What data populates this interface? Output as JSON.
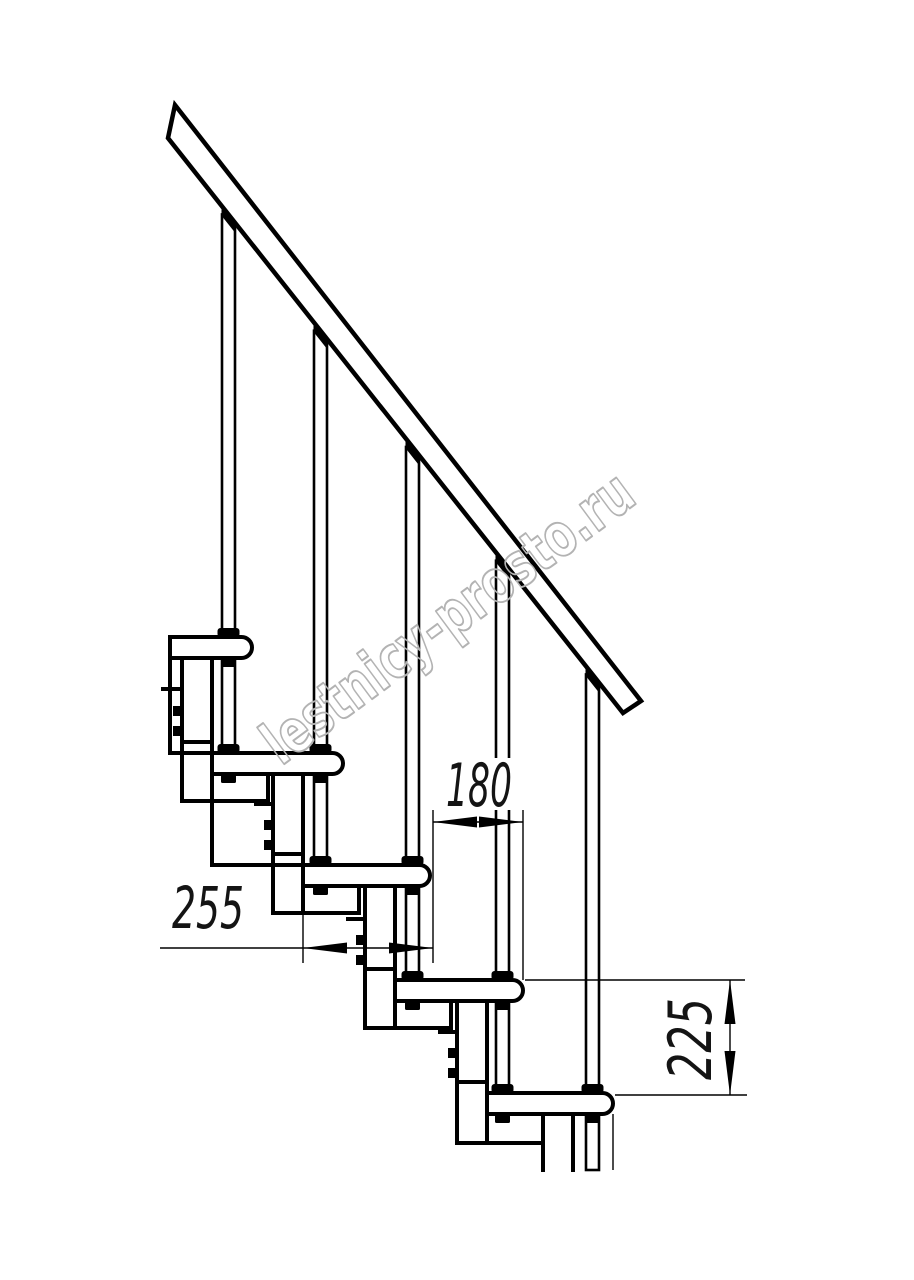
{
  "page": {
    "background": "#ffffff"
  },
  "drawing": {
    "type": "technical-drawing",
    "subject": "modular-staircase-side-elevation",
    "watermark": {
      "text": "lestnicy-prosto.ru",
      "color": "#b3b3b3",
      "angle_deg": -36.5,
      "cx": 460,
      "cy": 634,
      "font_size": 60,
      "text_length": 445
    },
    "dimensions": [
      {
        "label": "180",
        "meaning": "tread run spacing (mm)",
        "orientation": "horizontal"
      },
      {
        "label": "255",
        "meaning": "tread depth (mm)",
        "orientation": "horizontal"
      },
      {
        "label": "225",
        "meaning": "step rise (mm)",
        "orientation": "vertical"
      }
    ],
    "colors": {
      "line": "#000000",
      "dimension_text": "#141414",
      "watermark": "#b3b3b3"
    },
    "geometry": {
      "rail": {
        "points": "175,105 641,701 623,713 168,138"
      },
      "rail_ref": {
        "x0": 168,
        "y0": 138,
        "slope": 1.2637
      },
      "rods": {
        "centers": [
          228.5,
          320.5,
          412.5,
          502.5,
          592.5
        ],
        "width": 13,
        "bottom": 1170
      },
      "steps": {
        "h": 21,
        "r": 10.5,
        "items": [
          {
            "x": 170,
            "y": 637,
            "w": 82
          },
          {
            "x": 212,
            "y": 753,
            "w": 131
          },
          {
            "x": 303,
            "y": 865,
            "w": 127
          },
          {
            "x": 395,
            "y": 980,
            "w": 128
          },
          {
            "x": 487,
            "y": 1093,
            "w": 126
          }
        ]
      },
      "thick_v": [
        [
          170,
          637,
          753
        ],
        [
          182,
          658,
          801
        ],
        [
          212,
          658,
          865
        ],
        [
          268,
          774,
          801
        ],
        [
          273,
          774,
          913
        ],
        [
          303,
          774,
          913
        ],
        [
          359,
          886,
          913
        ],
        [
          365,
          886,
          1028
        ],
        [
          395,
          886,
          1028
        ],
        [
          451,
          1001,
          1028
        ],
        [
          457,
          1001,
          1143
        ],
        [
          487,
          1001,
          1143
        ],
        [
          543,
          1114,
          1170
        ],
        [
          573,
          1114,
          1170
        ]
      ],
      "thick_h": [
        [
          163,
          182,
          689
        ],
        [
          182,
          212,
          742
        ],
        [
          170,
          212,
          753
        ],
        [
          182,
          268,
          801
        ],
        [
          256,
          273,
          804
        ],
        [
          273,
          303,
          854
        ],
        [
          212,
          303,
          865
        ],
        [
          273,
          359,
          913
        ],
        [
          348,
          365,
          919
        ],
        [
          365,
          395,
          969
        ],
        [
          365,
          451,
          1028
        ],
        [
          440,
          457,
          1032
        ],
        [
          457,
          487,
          1082
        ],
        [
          457,
          543,
          1143
        ]
      ],
      "clips": [
        [
          173,
          706
        ],
        [
          173,
          726
        ],
        [
          264,
          820
        ],
        [
          264,
          840
        ],
        [
          356,
          935
        ],
        [
          356,
          955
        ],
        [
          448,
          1048
        ],
        [
          448,
          1068
        ]
      ],
      "clip_size": [
        9,
        10
      ],
      "thin_v": [
        [
          613,
          1114,
          1170
        ],
        [
          303,
          888,
          963
        ],
        [
          433,
          810,
          963
        ],
        [
          523,
          810,
          980
        ],
        [
          730,
          980,
          1095
        ]
      ],
      "thin_h": [
        [
          160,
          433,
          948
        ],
        [
          433,
          523,
          822
        ],
        [
          525,
          745,
          980
        ],
        [
          615,
          747,
          1095
        ]
      ],
      "arrows": [
        [
          303,
          948,
          347,
          942.5,
          347,
          953.5
        ],
        [
          433,
          948,
          389,
          942.5,
          389,
          953.5
        ],
        [
          433,
          822,
          477,
          816.5,
          477,
          827.5
        ],
        [
          523,
          822,
          479,
          816.5,
          479,
          827.5
        ],
        [
          730,
          980,
          724.5,
          1024,
          735.5,
          1024
        ],
        [
          730,
          1095,
          724.5,
          1051,
          735.5,
          1051
        ]
      ]
    }
  }
}
